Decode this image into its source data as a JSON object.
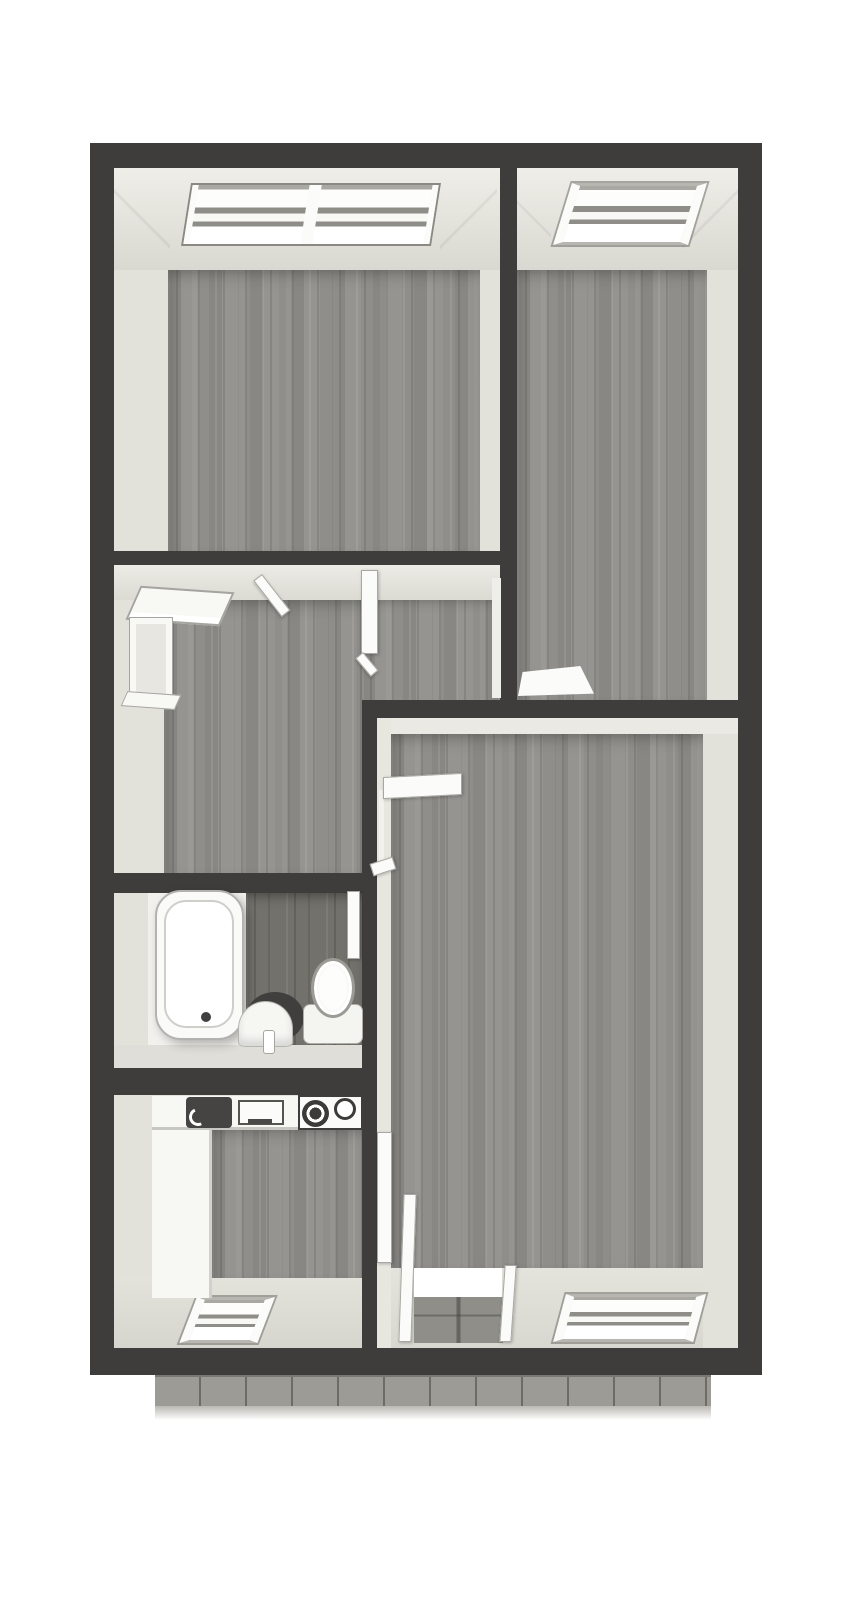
{
  "canvas": {
    "width": 867,
    "height": 1600
  },
  "colors": {
    "background": "#ffffff",
    "wall": "#3e3d3c",
    "wall_face": "#e2e1da",
    "wood_floor": "#8f8e8a",
    "wood_floor_dark": "#73716b",
    "fixture_white": "#fbfbf9",
    "fixture_edge": "#a8a7a2",
    "glass": "#f4f3ef",
    "balcony_tile": "#9c9b95"
  },
  "plan": {
    "type": "apartment-floor-plan-3d-top-view",
    "rooms": [
      {
        "name": "bedroom-top-left",
        "floor": "wood",
        "features": [
          "double-window-north",
          "door-to-hallway"
        ]
      },
      {
        "name": "bedroom-top-right",
        "floor": "wood",
        "features": [
          "window-north",
          "door-to-hallway"
        ]
      },
      {
        "name": "hallway",
        "floor": "wood",
        "features": [
          "window-west"
        ]
      },
      {
        "name": "bathroom",
        "floor": "dark-wood",
        "features": [
          "bathtub",
          "corner-sink",
          "toilet",
          "door-to-hallway"
        ]
      },
      {
        "name": "kitchen",
        "floor": "wood",
        "features": [
          "sink",
          "drainboard",
          "cooktop-2-burners",
          "counters",
          "window-south"
        ]
      },
      {
        "name": "living-room",
        "floor": "wood",
        "features": [
          "door-to-hallway",
          "balcony-door-south",
          "window-south"
        ]
      }
    ],
    "balcony": {
      "name": "balcony-terrace",
      "position": "south",
      "surface": "tiles"
    }
  }
}
